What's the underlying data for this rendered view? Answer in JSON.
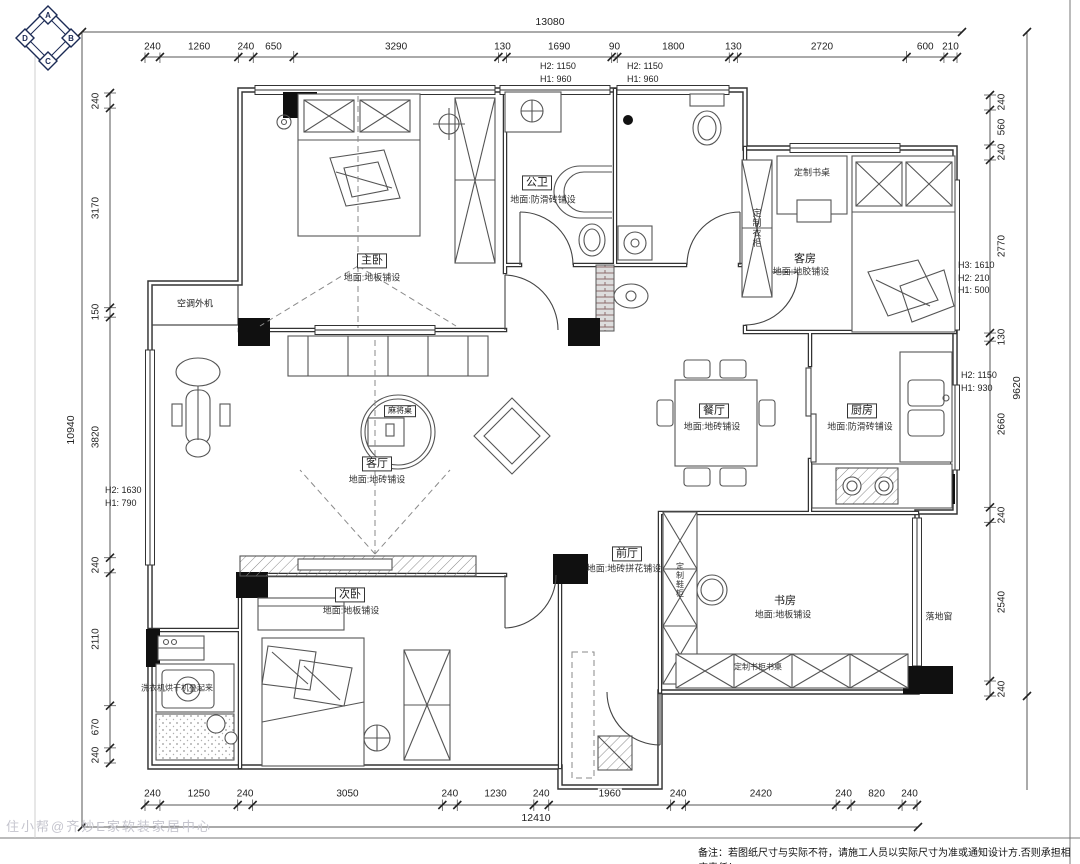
{
  "compass": {
    "n": "A",
    "e": "B",
    "s": "C",
    "w": "D"
  },
  "dimensions": {
    "top": {
      "total": "13080",
      "segments": [
        "240",
        "1260",
        "240",
        "650",
        "3290",
        "130",
        "1690",
        "90",
        "1800",
        "130",
        "2720",
        "600",
        "210"
      ]
    },
    "bottom": {
      "total": "12410",
      "segments": [
        "240",
        "1250",
        "240",
        "3050",
        "240",
        "1230",
        "240",
        "1960",
        "240",
        "2420",
        "240",
        "820",
        "240"
      ]
    },
    "left": {
      "total": "10940",
      "segments": [
        "240",
        "3170",
        "150",
        "3820",
        "240",
        "2110",
        "670",
        "240"
      ]
    },
    "right": {
      "total": "9620",
      "segments": [
        "240",
        "560",
        "240",
        "2770",
        "130",
        "2660",
        "240",
        "2540",
        "240"
      ]
    }
  },
  "annotations": {
    "top_window_1": "H2: 1150\nH1: 960",
    "top_window_2": "H2: 1150\nH1: 960",
    "left_window": "H2: 1630\nH1: 790",
    "right_window_1": "H3: 1610\nH2: 210\nH1: 500",
    "right_window_2": "H2: 1150\nH1: 930"
  },
  "rooms": {
    "master": {
      "name": "主卧",
      "floor": "地面:地板铺设"
    },
    "bath": {
      "name": "公卫",
      "floor": "地面:防滑砖铺设"
    },
    "guest": {
      "name": "客房",
      "floor": "地面:地胶铺设"
    },
    "dining": {
      "name": "餐厅",
      "floor": "地面:地砖铺设"
    },
    "kitchen": {
      "name": "厨房",
      "floor": "地面:防滑砖铺设"
    },
    "living": {
      "name": "客厅",
      "floor": "地面:地砖铺设"
    },
    "foyer": {
      "name": "前厅",
      "floor": "地面:地砖拼花铺设"
    },
    "second": {
      "name": "次卧",
      "floor": "地面:地板铺设"
    },
    "study": {
      "name": "书房",
      "floor": "地面:地板铺设"
    },
    "ac": {
      "name": "空调外机"
    }
  },
  "furniture_labels": {
    "guest_desk": "定制书桌",
    "guest_wardrobe": "定制衣柜",
    "shoe_cabinet": "定制鞋柜",
    "book_cabinet": "定制书柜书桌",
    "floor_window": "落地窗",
    "mahjong_table": "麻将桌",
    "laundry": "洗衣机烘干机叠起来"
  },
  "footer": {
    "note": "备注：若图纸尺寸与实际不符，请施工人员以实际尺寸为准或通知设计方.否则承担相应责任！",
    "watermark": "住小帮@齐妙E家软装家居中心"
  }
}
